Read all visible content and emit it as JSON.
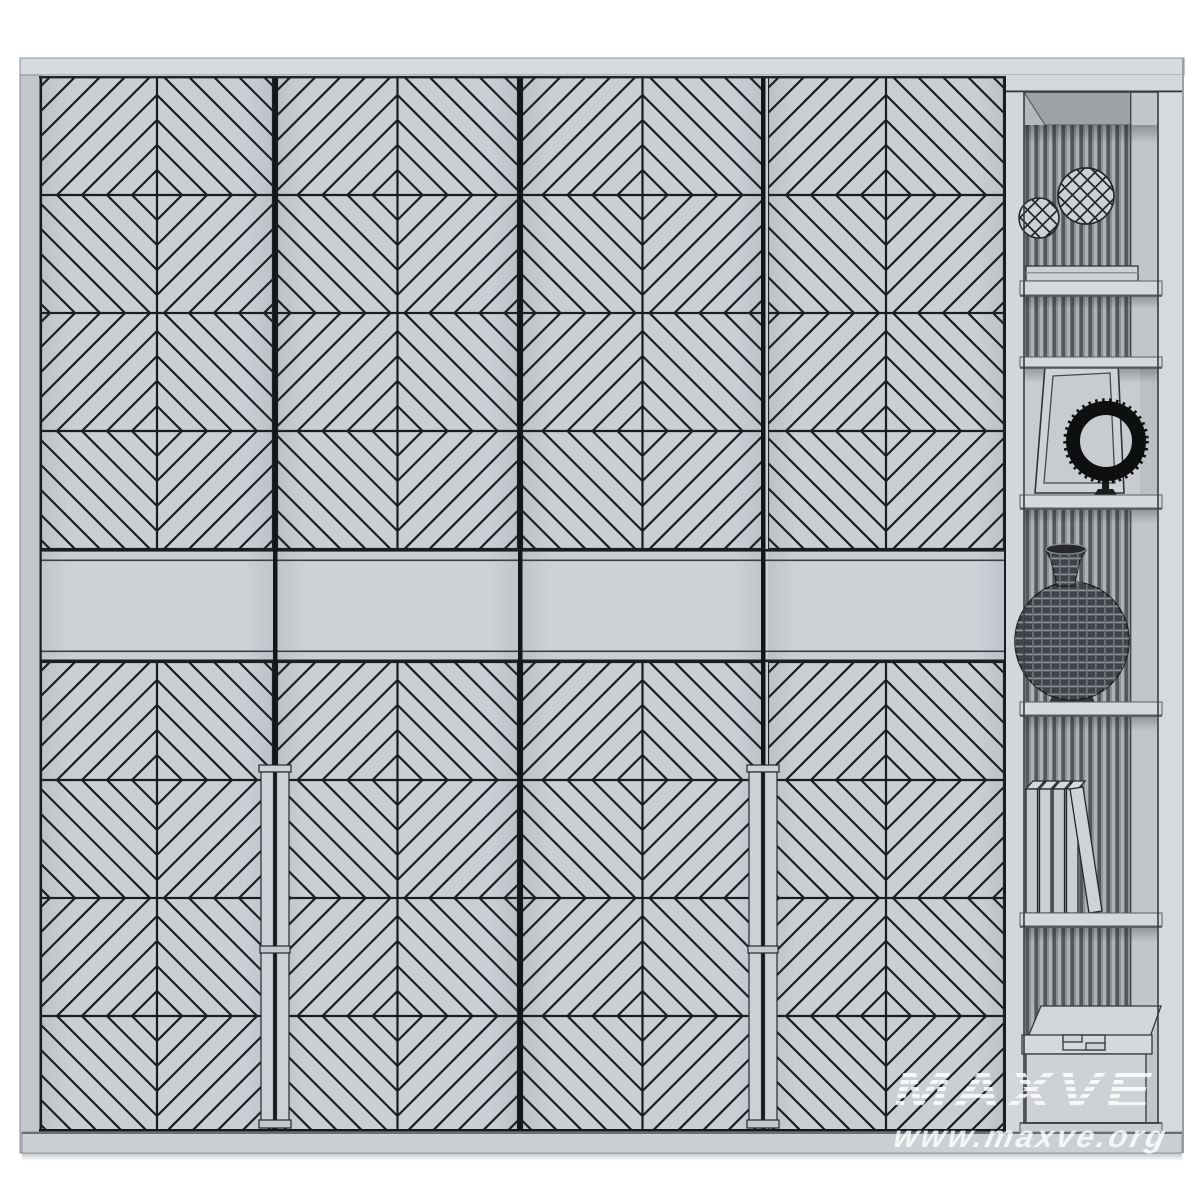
{
  "watermark": {
    "brand": "MAXVE",
    "website": "www.maxve.org"
  },
  "palette": {
    "background": "#ffffff",
    "door_face": "#cbcfd4",
    "band_face": "#ced2d7",
    "pattern_line": "#1a1c1f",
    "gap_line": "#14161a",
    "top_panel": "#d7dade",
    "left_panel": "#c3c7cb",
    "plinth": "#ccd0d4",
    "unit_frame": "#d4d7db",
    "interior_back": "#b5b9be",
    "rib_dark": "#54585d",
    "rib_light": "#aeb2b7",
    "shelf_board": "#d5d8dc",
    "object_dark": "#0e0f10",
    "vase_body": "#3f4348",
    "watermark_color": "#ffffff"
  },
  "wardrobe": {
    "door_top": 77,
    "door_bottom": 1131,
    "doors": [
      {
        "x": 41,
        "w": 232
      },
      {
        "x": 277,
        "w": 241
      },
      {
        "x": 522,
        "w": 241
      },
      {
        "x": 768,
        "w": 236
      }
    ],
    "pattern_rows_y": [
      77,
      313,
      662,
      898
    ],
    "tile": {
      "height": 236,
      "diamond_spacing": 25,
      "max_radius": 225,
      "stroke_width": 2.2
    },
    "band": {
      "top": 549,
      "bottom": 662
    },
    "handle_gaps_x": [
      275,
      763
    ]
  },
  "shelf_unit": {
    "items": [
      {
        "shelf": "1-top",
        "name": "faceted-decor-sphere-large"
      },
      {
        "shelf": "1-top",
        "name": "faceted-decor-sphere-small"
      },
      {
        "shelf": "2",
        "name": "flat-book"
      },
      {
        "shelf": "3",
        "name": "leaning-picture-frame"
      },
      {
        "shelf": "3",
        "name": "black-beaded-wreath-on-stand"
      },
      {
        "shelf": "4",
        "name": "lattice-vase"
      },
      {
        "shelf": "5",
        "name": "books-row-one-leaning"
      },
      {
        "shelf": "6-bottom",
        "name": "storage-box-with-lid"
      }
    ]
  }
}
